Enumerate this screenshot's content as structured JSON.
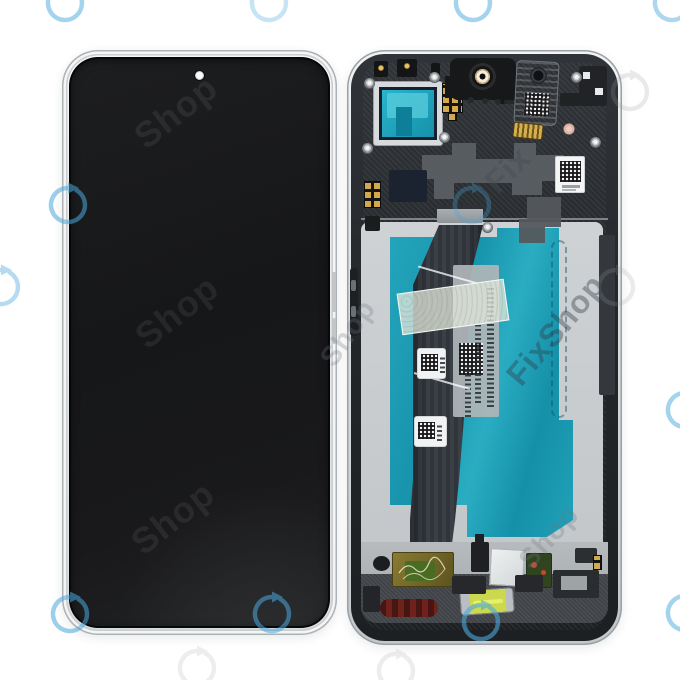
{
  "meta": {
    "alt": "Product photo: smartphone LCD display assembly with middle frame — front view (black screen with punch-hole camera) on the left, back view (frame with teal film, flex cable, speaker, camera window and components) on the right, on white background with FixShop watermarks"
  },
  "colors": {
    "bg": "#ffffff",
    "screen-black": "#18191a",
    "frame-silver": "#e6e8ea",
    "frame-dark": "#26292c",
    "plate-gray": "#b2b6b9",
    "teal-film": "#1e9cb6",
    "teal-bright": "#2ab4cb",
    "teal-deep": "#0e7f99",
    "flex-slate": "#363a41",
    "gold": "#d2a94c",
    "navy-chip": "#1c2330",
    "gasket-red": "#6f211b",
    "lime-part": "#ccd84e",
    "pcb-olive": "#7d7030",
    "pcb-green": "#44631f",
    "ring-blue": "#4aa8dc",
    "ring-gray": "#9aa0a6"
  },
  "watermark": {
    "brand": "FixShop",
    "tones": {
      "screen": "rgba(255,255,255,0.07)",
      "light": "rgba(110,120,128,0.28)",
      "mid": "rgba(70,76,84,0.45)",
      "teal": "rgba(50,60,72,0.40)"
    },
    "texts": [
      {
        "text": "Shop",
        "x": 176,
        "y": 112,
        "rot": -38,
        "size": 36,
        "tone": "screen"
      },
      {
        "text": "Shop",
        "x": 177,
        "y": 312,
        "rot": -38,
        "size": 36,
        "tone": "screen"
      },
      {
        "text": "Shop",
        "x": 173,
        "y": 518,
        "rot": -38,
        "size": 36,
        "tone": "screen"
      },
      {
        "text": "Shop",
        "x": 348,
        "y": 333,
        "rot": -55,
        "size": 28,
        "tone": "light"
      },
      {
        "text": "Fix",
        "x": 508,
        "y": 170,
        "rot": -45,
        "size": 32,
        "tone": "mid"
      },
      {
        "text": "FixShop",
        "x": 556,
        "y": 330,
        "rot": -50,
        "size": 32,
        "tone": "teal"
      },
      {
        "text": "Shop",
        "x": 549,
        "y": 537,
        "rot": -48,
        "size": 28,
        "tone": "light"
      }
    ],
    "rings_blue": [
      {
        "x": 65,
        "y": 3,
        "o": 0.5
      },
      {
        "x": 269,
        "y": 3,
        "o": 0.3
      },
      {
        "x": 473,
        "y": 3,
        "o": 0.5
      },
      {
        "x": 672,
        "y": 3,
        "o": 0.45
      },
      {
        "x": 68,
        "y": 205,
        "o": 0.55
      },
      {
        "x": 472,
        "y": 205,
        "o": 0.3
      },
      {
        "x": 1,
        "y": 287,
        "o": 0.4
      },
      {
        "x": 685,
        "y": 410,
        "o": 0.5
      },
      {
        "x": 70,
        "y": 614,
        "o": 0.55
      },
      {
        "x": 272,
        "y": 614,
        "o": 0.55
      },
      {
        "x": 481,
        "y": 622,
        "o": 0.6
      },
      {
        "x": 685,
        "y": 613,
        "o": 0.5
      }
    ],
    "rings_gray": [
      {
        "x": 630,
        "y": 92,
        "o": 0.22
      },
      {
        "x": 616,
        "y": 287,
        "o": 0.2
      },
      {
        "x": 197,
        "y": 668,
        "o": 0.18
      },
      {
        "x": 396,
        "y": 671,
        "o": 0.18
      }
    ]
  }
}
